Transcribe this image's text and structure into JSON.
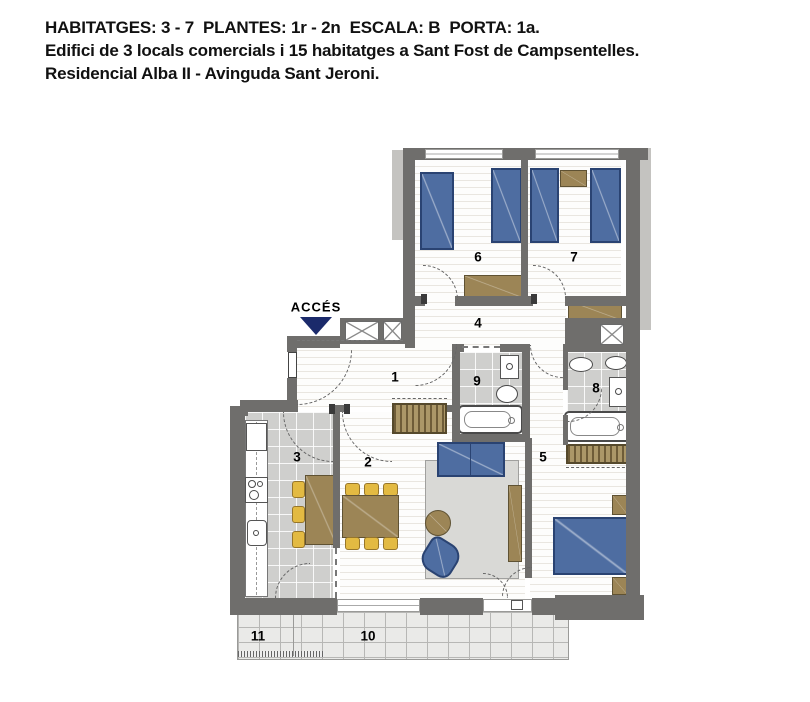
{
  "header": {
    "line1": "HABITATGES: 3 - 7  PLANTES: 1r - 2n  ESCALA: B  PORTA: 1a.",
    "line2": "Edifici de 3 locals comercials i 15 habitatges a Sant Fost de Campsentelles.",
    "line3": "Residencial Alba II - Avinguda Sant Jeroni."
  },
  "plan": {
    "access_label": "ACCÉS",
    "rooms": [
      "1",
      "2",
      "3",
      "4",
      "5",
      "6",
      "7",
      "8",
      "9",
      "10",
      "11"
    ],
    "colors": {
      "wall_gray": "#6f6e6c",
      "bed_blue": "#4e6da1",
      "furniture_brown": "#9c8556",
      "chair_yellow": "#e3ba42",
      "access_navy": "#1b2a6b",
      "tile_gray": "#cfcfcd",
      "terrace_gray": "#eaeae8"
    }
  }
}
